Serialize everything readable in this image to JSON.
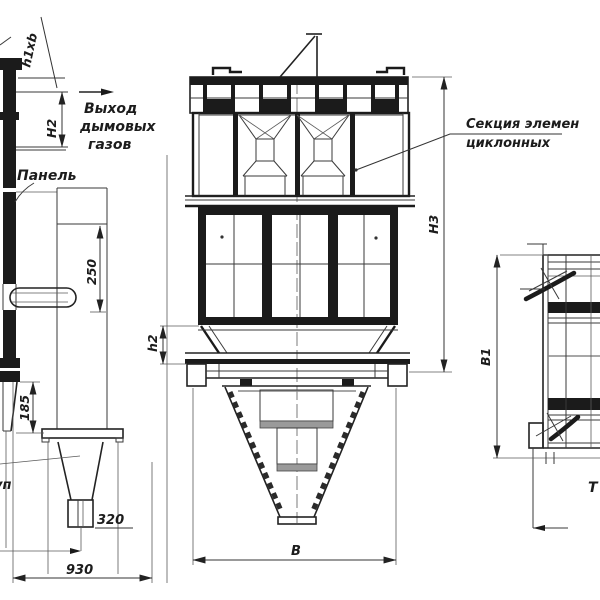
{
  "drawing": {
    "kind": "engineering dimensional drawing of a multi-cyclone (battery cyclone) dust collector, three orthographic views, black line art on white"
  },
  "labels": {
    "outlet_l1": "Выход",
    "outlet_l2": "дымовых",
    "outlet_l3": "газов",
    "panel": "Панель",
    "section_l1": "Секция элемен",
    "section_l2": "циклонных",
    "left_fragment": "уп",
    "right_fragment": "Т"
  },
  "dims": {
    "h1xb": "h1xb",
    "H2": "H2",
    "v250": "250",
    "v185": "185",
    "v320": "320",
    "v930": "930",
    "h2": "h2",
    "H3": "H3",
    "B": "B",
    "B1": "B1"
  }
}
